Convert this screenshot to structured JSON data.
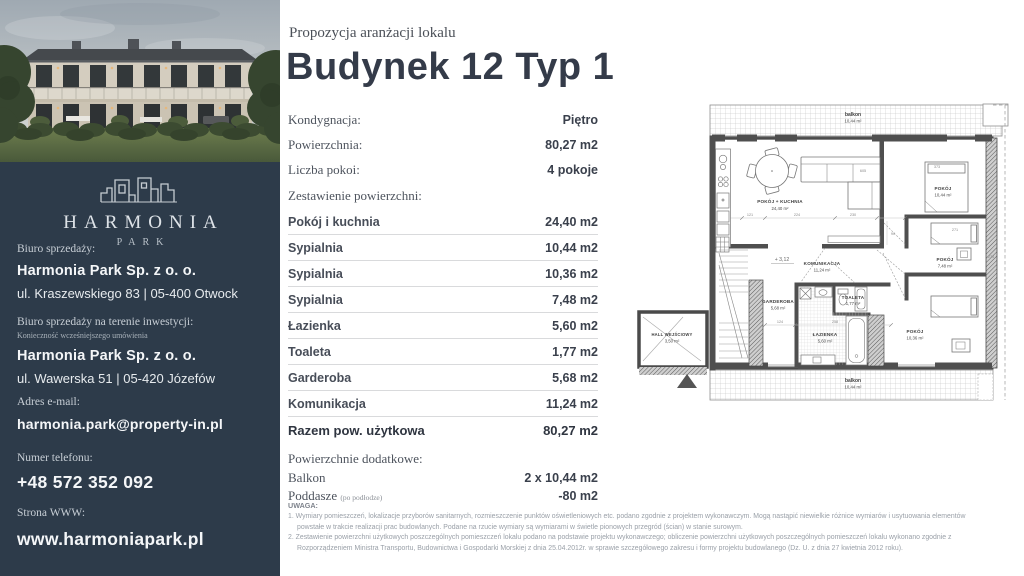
{
  "header": {
    "kicker": "Propozycja aranżacji lokalu",
    "title": "Budynek 12 Typ 1"
  },
  "sidebar": {
    "logo_text": "HARMONIA",
    "logo_sub": "PARK",
    "office": {
      "label": "Biuro sprzedaży:",
      "company": "Harmonia Park Sp. z o. o.",
      "address": "ul. Kraszewskiego 83 | 05-400 Otwock"
    },
    "site_office": {
      "label": "Biuro sprzedaży na terenie inwestycji:",
      "note": "Konieczność wcześniejszego umówienia",
      "company": "Harmonia Park Sp. z o. o.",
      "address": "ul. Wawerska 51 | 05-420 Józefów"
    },
    "email": {
      "label": "Adres e-mail:",
      "value": "harmonia.park@property-in.pl"
    },
    "phone": {
      "label": "Numer telefonu:",
      "value": "+48 572 352 092"
    },
    "www": {
      "label": "Strona WWW:",
      "value": "www.harmoniapark.pl"
    }
  },
  "meta": {
    "rows": [
      {
        "label": "Kondygnacja:",
        "value": "Piętro"
      },
      {
        "label": "Powierzchnia:",
        "value": "80,27 m2"
      },
      {
        "label": "Liczba pokoi:",
        "value": "4 pokoje"
      }
    ],
    "section_label": "Zestawienie powierzchni:"
  },
  "areas": {
    "rows": [
      {
        "label": "Pokój i kuchnia",
        "value": "24,40 m2"
      },
      {
        "label": "Sypialnia",
        "value": "10,44 m2"
      },
      {
        "label": "Sypialnia",
        "value": "10,36 m2"
      },
      {
        "label": "Sypialnia",
        "value": "7,48 m2"
      },
      {
        "label": "Łazienka",
        "value": "5,60 m2"
      },
      {
        "label": "Toaleta",
        "value": "1,77 m2"
      },
      {
        "label": "Garderoba",
        "value": "5,68 m2"
      },
      {
        "label": "Komunikacja",
        "value": "11,24 m2"
      }
    ],
    "total": {
      "label": "Razem pow. użytkowa",
      "value": "80,27 m2"
    }
  },
  "additional": {
    "label": "Powierzchnie dodatkowe:",
    "rows": [
      {
        "label": "Balkon",
        "value": "2 x 10,44 m2"
      },
      {
        "label": "Poddasze",
        "note": "(po podłodze)",
        "value": "-80 m2"
      }
    ]
  },
  "notes": {
    "heading": "UWAGA:",
    "items": [
      "1. Wymiary pomieszczeń, lokalizacje przyborów sanitarnych, rozmieszczenie punktów oświetleniowych etc. podano zgodnie z projektem wykonawczym. Mogą nastąpić niewielkie różnice wymiarów i usytuowania elementów powstałe w trakcie realizacji prac budowlanych. Podane na rzucie wymiary są wymiarami w świetle pionowych przegród (ścian) w stanie surowym.",
      "2. Zestawienie powierzchni użytkowych poszczególnych pomieszczeń lokalu podano na podstawie projektu wykonawczego; obliczenie powierzchni użytkowych poszczególnych pomieszczeń lokalu wykonano zgodnie z Rozporządzeniem Ministra Transportu, Budownictwa i Gospodarki Morskiej z dnia 25.04.2012r. w sprawie szczegółowego zakresu i formy projektu budowlanego (Dz. U. z dnia 27 kwietnia 2012 roku)."
    ]
  },
  "floorplan": {
    "level_marker": "+ 3,12",
    "rooms": [
      {
        "name": "balkon",
        "area": "10,44 m²"
      },
      {
        "name": "POKÓJ + KUCHNIA",
        "area": "24,40 m²"
      },
      {
        "name": "POKÓJ",
        "area": "10,44 m²"
      },
      {
        "name": "POKÓJ",
        "area": "7,48 m²"
      },
      {
        "name": "KOMUNIKACJA",
        "area": "11,24 m²"
      },
      {
        "name": "GARDEROBA",
        "area": "5,68 m²"
      },
      {
        "name": "ŁAZIENKA",
        "area": "5,60 m²"
      },
      {
        "name": "TOALETA",
        "area": "1,77 m²"
      },
      {
        "name": "POKÓJ",
        "area": "10,36 m²"
      },
      {
        "name": "HALL WEJŚCIOWY",
        "area": "3,50 m²"
      },
      {
        "name": "balkon",
        "area": "10,44 m²"
      }
    ],
    "dims": [
      {
        "v": "605"
      },
      {
        "v": "121"
      },
      {
        "v": "224"
      },
      {
        "v": "230"
      },
      {
        "v": "90"
      },
      {
        "v": "124"
      },
      {
        "v": "258"
      },
      {
        "v": "373"
      },
      {
        "v": "271"
      },
      {
        "v": "275"
      }
    ]
  },
  "colors": {
    "sidebar_bg": "#2d3b4a",
    "heading_text": "#343b49",
    "row_border": "#d9dadc",
    "plan_wall": "#4f4f4f"
  }
}
